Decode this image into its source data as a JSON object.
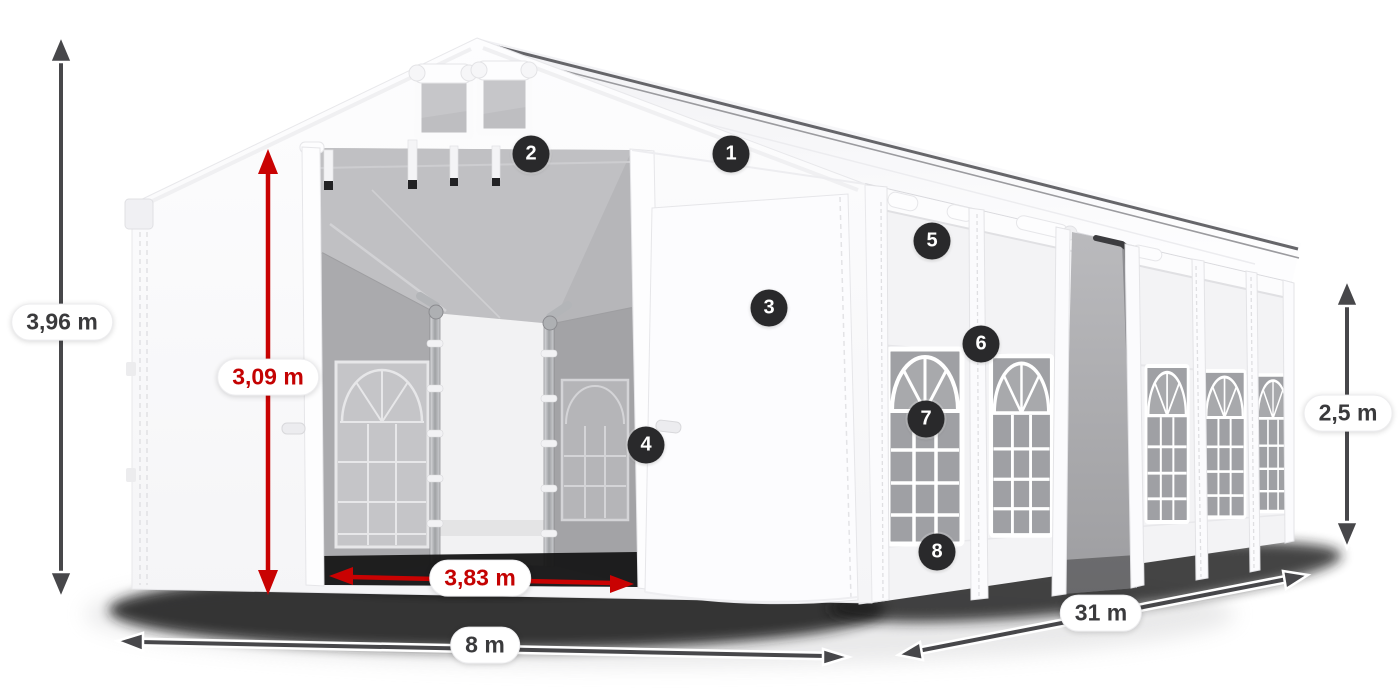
{
  "diagram": {
    "type": "product-dimension-diagram",
    "dimension_labels": [
      {
        "id": "total-height",
        "text": "3,96 m",
        "style": "dark"
      },
      {
        "id": "door-height",
        "text": "3,09 m",
        "style": "red"
      },
      {
        "id": "door-width",
        "text": "3,83 m",
        "style": "red"
      },
      {
        "id": "total-width",
        "text": "8 m",
        "style": "dark"
      },
      {
        "id": "total-length",
        "text": "31 m",
        "style": "dark"
      },
      {
        "id": "side-height",
        "text": "2,5 m",
        "style": "dark"
      }
    ],
    "feature_markers": [
      {
        "number": "1"
      },
      {
        "number": "2"
      },
      {
        "number": "3"
      },
      {
        "number": "4"
      },
      {
        "number": "5"
      },
      {
        "number": "6"
      },
      {
        "number": "7"
      },
      {
        "number": "8"
      }
    ],
    "colors": {
      "dimension_dark": "#47474a",
      "dimension_red": "#c90202",
      "marker_background": "#29292b",
      "marker_text": "#ffffff",
      "label_background": "#ffffff",
      "label_text_dark": "#3a3a3c",
      "label_text_red": "#c40202",
      "tent_white": "#fbfbfd",
      "interior_gray": "#ababae",
      "ground_shadow": "#161616"
    }
  }
}
